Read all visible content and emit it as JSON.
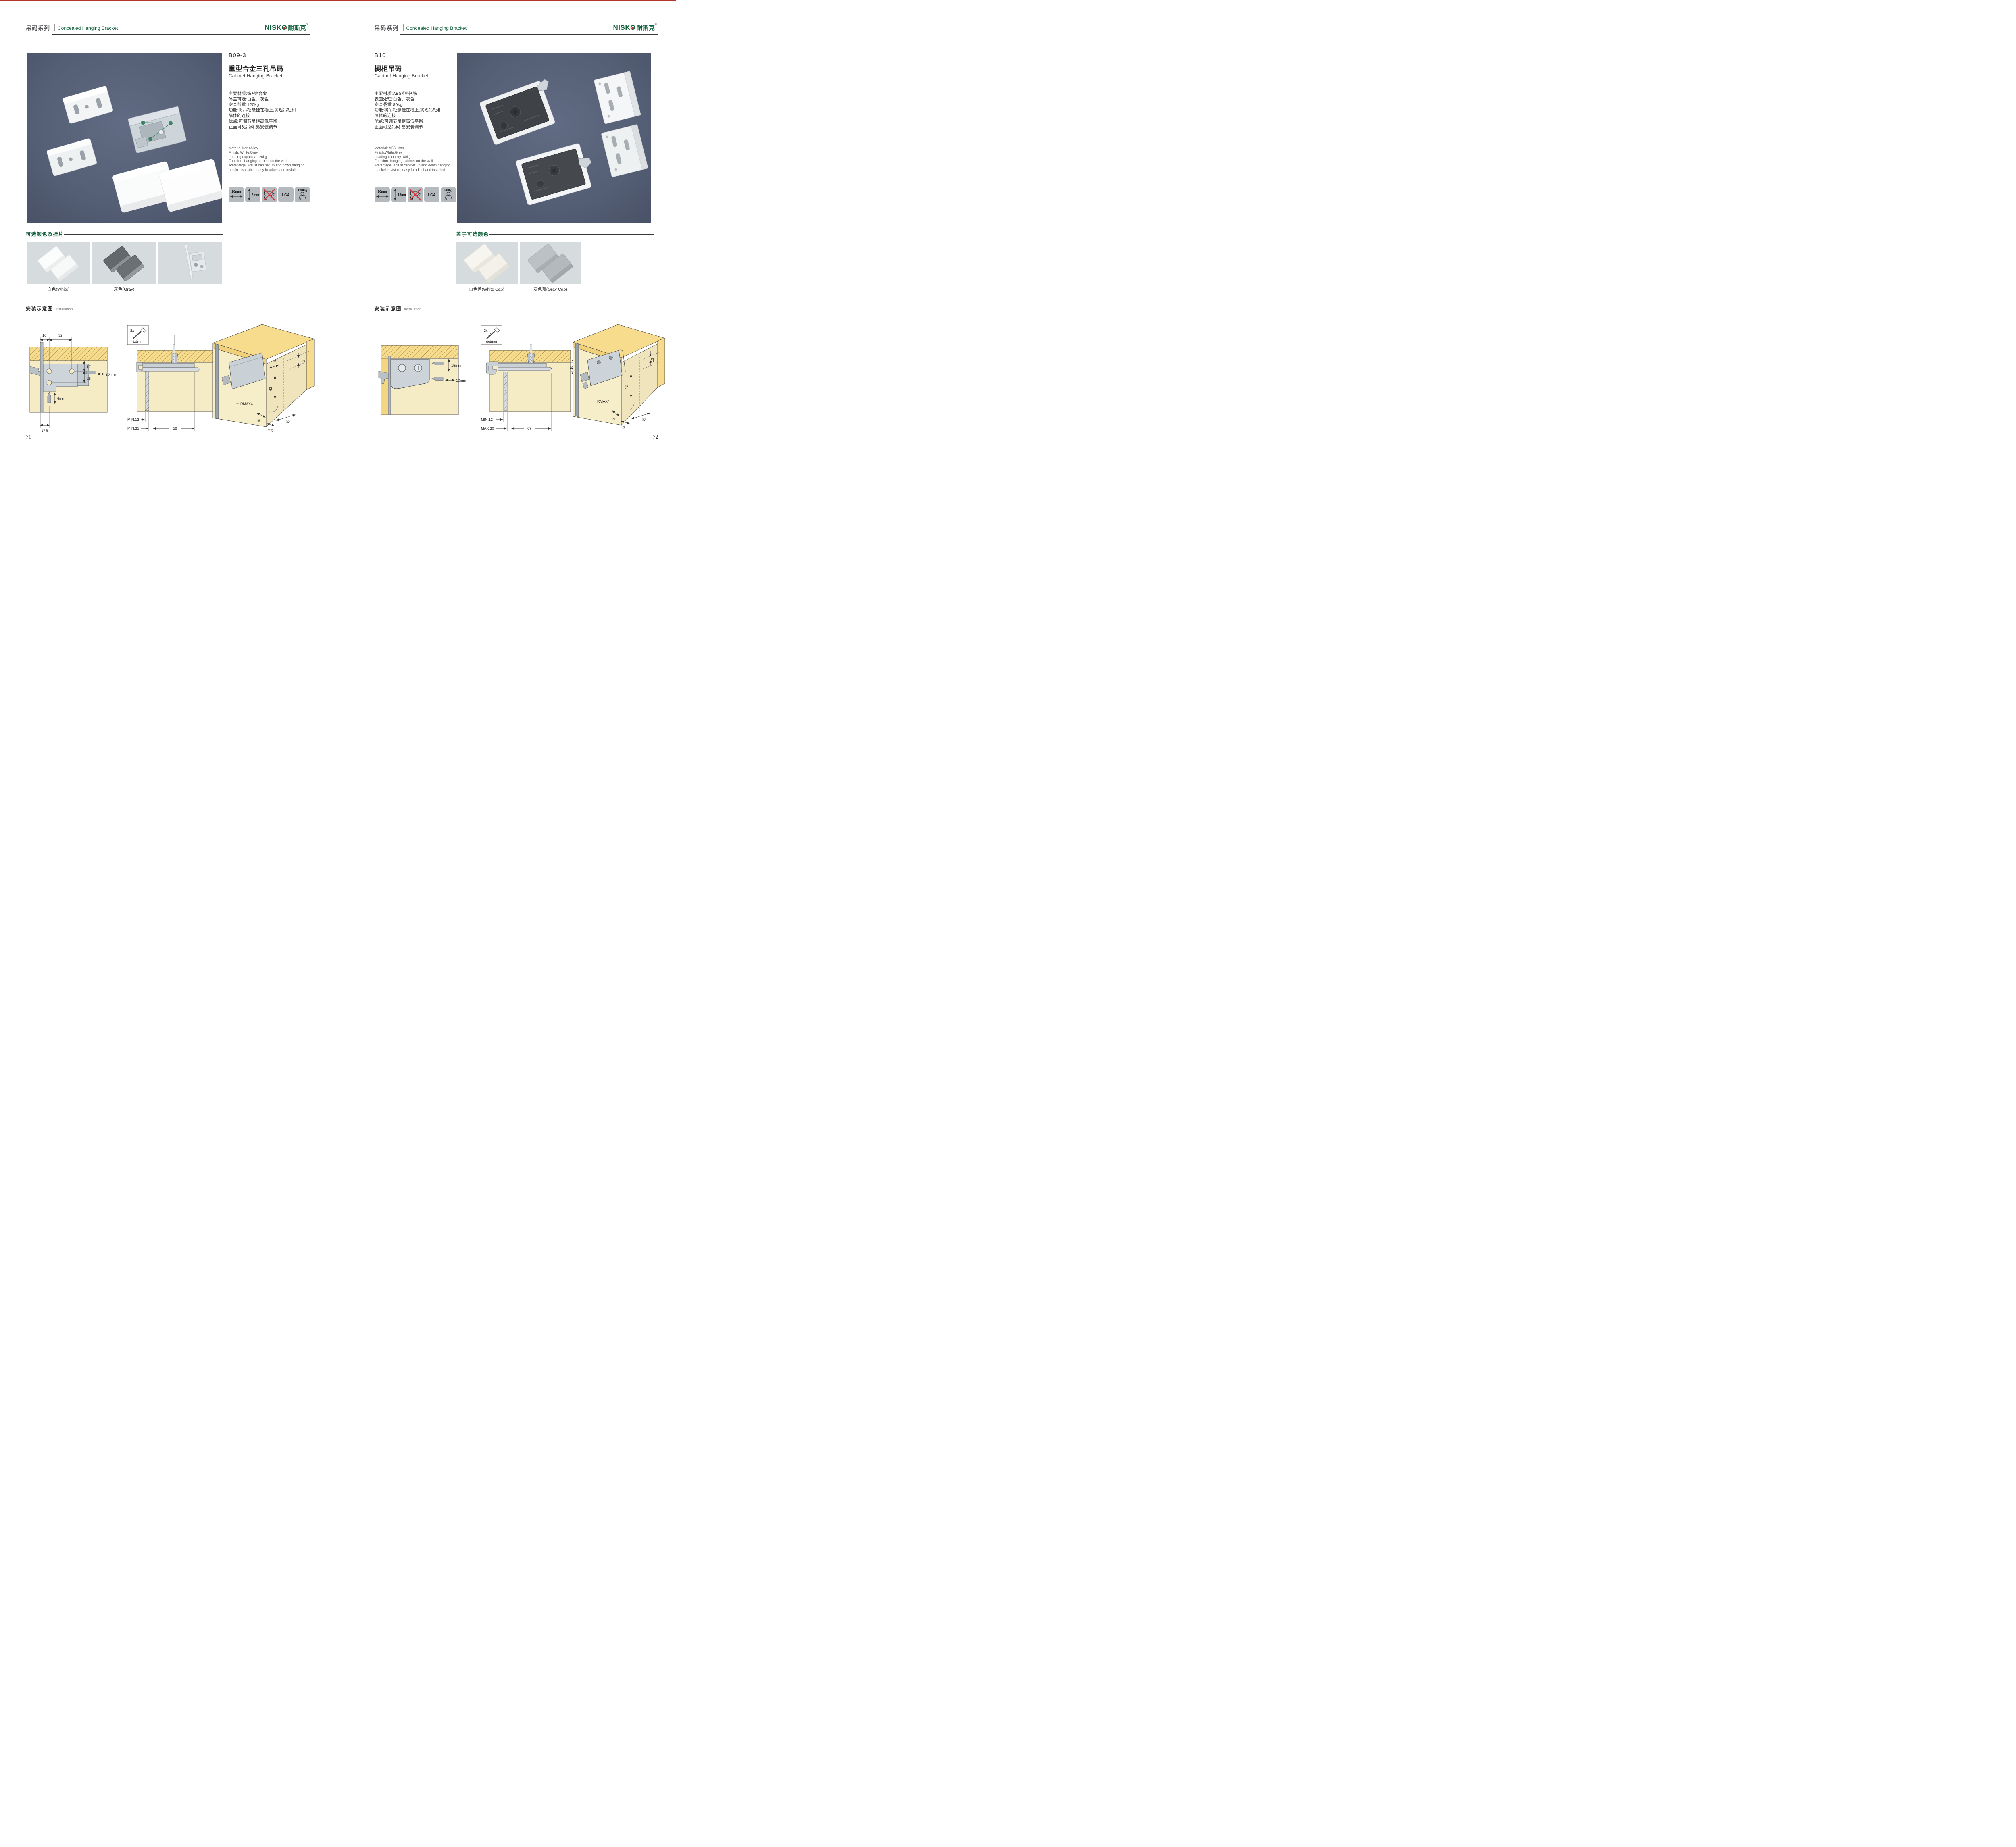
{
  "brand": {
    "en": "NISKO",
    "cn": "耐斯克",
    "reg": "®"
  },
  "colors": {
    "accent_green": "#15613e",
    "header_rule": "#2b2b2b",
    "photo_background": "#57617a",
    "swatch_background": "#d6dbde",
    "icon_tile": "#b5babe",
    "wood_yellow": "#f8dc8e",
    "panel_tan": "#f5ecc6",
    "warning_red": "#d6363a"
  },
  "left_page": {
    "header": {
      "series_cn": "吊码系列",
      "series_en": "Concealed Hanging Bracket"
    },
    "product": {
      "model": "B09-3",
      "name_cn": "重型合金三孔吊码",
      "name_en": "Cabinet Hanging Bracket",
      "specs_cn": [
        "主要材质:铁+锌合金",
        "外盖可选:白色、灰色",
        "安全载重:120kg",
        "功能:将吊柜悬挂在墙上,实现吊柜和",
        "墙体的连接",
        "优点:可调节吊柜高低平衡",
        "正面可见吊码,易安装调节"
      ],
      "specs_en": [
        "Material:Iron+Alloy",
        "Finish: White,Grey",
        "Loading capacity: 120kg",
        "Function: hanging cabinet on the wall",
        "Advantage: Adjust cabinet up and down hanging",
        "bracket is visible, easy to adjust and installed"
      ],
      "icons": [
        {
          "name": "width-arrow-icon",
          "label": "20mm"
        },
        {
          "name": "height-arrow-icon",
          "label": "6mm"
        },
        {
          "name": "no-drill-icon",
          "label": ""
        },
        {
          "name": "lga-icon",
          "label": "LGA"
        },
        {
          "name": "load-capacity-icon",
          "label": "120Kg"
        }
      ]
    },
    "colors_section": {
      "title": "可选颜色及挂片",
      "labels": [
        "白色(White)",
        "灰色(Gray)"
      ]
    },
    "installation": {
      "title_cn": "安装示意图",
      "title_en": "Installation",
      "screw_box": {
        "count": "2x",
        "dia": "Φ4mm"
      },
      "d1": {
        "a": "16",
        "b": "32",
        "c": "17",
        "d": "25",
        "e": "20mm",
        "f": "6mm",
        "g": "17.5"
      },
      "d2": {
        "a": "12",
        "b": "MIN.12",
        "c": "MIN.35",
        "d": "58"
      },
      "d3": {
        "a": "16",
        "b": "17",
        "c": "42",
        "d": "RMAX4",
        "e": "16",
        "f": "32",
        "g": "17.5"
      }
    },
    "page_number": "71"
  },
  "right_page": {
    "header": {
      "series_cn": "吊码系列",
      "series_en": "Concealed Hanging Bracket"
    },
    "product": {
      "model": "B10",
      "name_cn": "橱柜吊码",
      "name_en": "Cabinet Hanging Bracket",
      "specs_cn": [
        "主要材质:ABS塑料+铁",
        "表面处理:白色、灰色",
        "安全载重:80kg",
        "功能:将吊柜悬挂在墙上,实现吊柜和",
        "墙体的连接",
        "优点:可调节吊柜高低平衡",
        "正面可见吊码,易安装调节"
      ],
      "specs_en": [
        "Material: ABS+iron",
        "Finish:White,Grey",
        "Loading capacity: 80kg",
        "Function: hanging cabinet on the wall",
        "Advantage: Adjust cabinet up and down hanging",
        "bracket is visible, easy to adjust and installed"
      ],
      "icons": [
        {
          "name": "width-arrow-icon",
          "label": "10mm"
        },
        {
          "name": "height-arrow-icon",
          "label": "15mm"
        },
        {
          "name": "no-drill-icon",
          "label": ""
        },
        {
          "name": "lga-icon",
          "label": "LGA"
        },
        {
          "name": "load-capacity-icon",
          "label": "80Kg"
        }
      ]
    },
    "colors_section": {
      "title": "盖子可选颜色",
      "labels": [
        "白色盖(White Cap)",
        "灰色盖(Gray Cap)"
      ]
    },
    "installation": {
      "title_cn": "安装示意图",
      "title_en": "Installation",
      "screw_box": {
        "count": "2x",
        "dia": "Φ4mm"
      },
      "d1": {
        "a": "15mm",
        "b": "10mm"
      },
      "d2": {
        "a": "18",
        "b": "MIN.12",
        "c": "MAX.30",
        "d": "67"
      },
      "d3": {
        "a": "13",
        "b": "42",
        "c": "RMAX4",
        "d": "19",
        "e": "17",
        "f": "32"
      }
    },
    "page_number": "72"
  }
}
